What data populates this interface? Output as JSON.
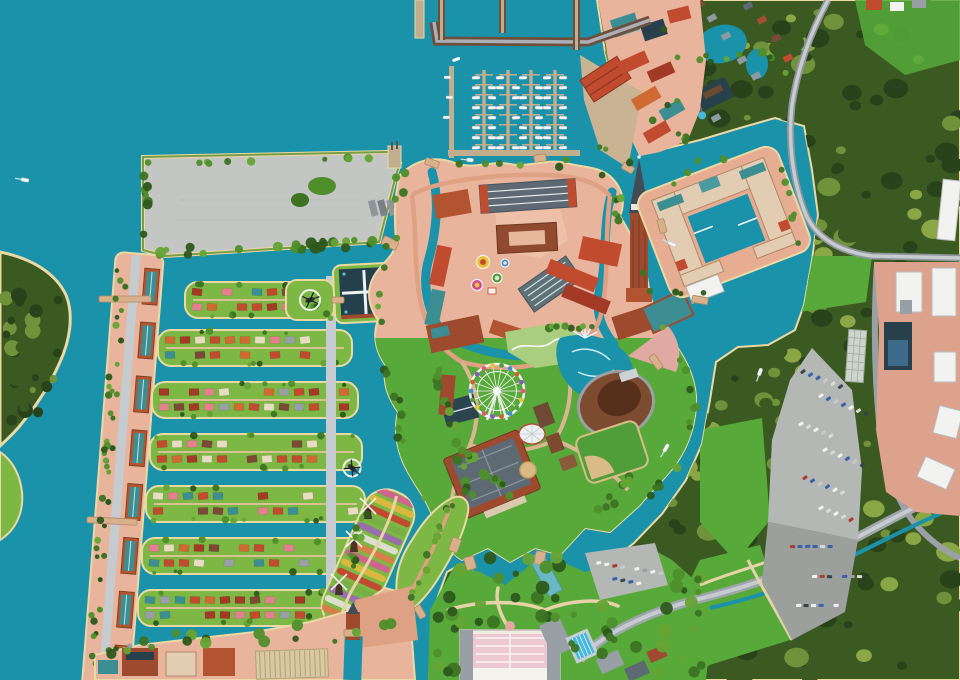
{
  "map": {
    "title": "illustrated-aerial-resort-park-map",
    "description": "Stylized bird's-eye illustrated map of a European canal-town theme resort: marina with boats, fortified central town with cathedral tower, hotel island, amusement gardens with ferris wheel and amphitheater, canal-side residential islands, windmill tulip island, polder field, dense eastern forest with parking and logistics zone.",
    "visible_labels": [],
    "regions": [
      {
        "id": "ocean",
        "label": "Harbor bay water"
      },
      {
        "id": "polder-field",
        "label": "Gray polder event field"
      },
      {
        "id": "marina",
        "label": "Yacht marina"
      },
      {
        "id": "harbor-town",
        "label": "Harbor warehouse town"
      },
      {
        "id": "central-town",
        "label": "Fortified central town"
      },
      {
        "id": "hotel-europe",
        "label": "Canal hotel island"
      },
      {
        "id": "amusement-zone",
        "label": "Amusement gardens"
      },
      {
        "id": "residential-district",
        "label": "Canal residential islands"
      },
      {
        "id": "seaside-boulevard",
        "label": "Seaside condominium boulevard"
      },
      {
        "id": "windmill-island",
        "label": "Windmill tulip island"
      },
      {
        "id": "flower-road-island",
        "label": "Flower road island"
      },
      {
        "id": "south-gardens",
        "label": "South palace gardens"
      },
      {
        "id": "entrance-district",
        "label": "Entrance village"
      },
      {
        "id": "forest-east",
        "label": "Eastern forest"
      },
      {
        "id": "cottage-resort",
        "label": "Forest cottage resort"
      },
      {
        "id": "industrial-zone",
        "label": "Logistics / industrial zone"
      },
      {
        "id": "parking-lot",
        "label": "Main parking lot"
      },
      {
        "id": "left-headland",
        "label": "Wooded headland"
      }
    ],
    "landmarks": [
      "dom-tower",
      "grand-hotel-block",
      "plaza",
      "arcade-hall",
      "ferris-wheel",
      "amphitheater",
      "fountain-lake",
      "dome-tent",
      "museum-palace",
      "sports-field",
      "white-palace-garden",
      "helipads",
      "lock-dam",
      "breakwater"
    ],
    "palette": {
      "water": "#1a92aa",
      "sand": "#ead9a5",
      "forest": "#3a5a22",
      "forest_dark": "#28431a",
      "forest_light": "#6f923a",
      "forest_pale": "#8aa746",
      "lawn": "#57aa3a",
      "lawn_light": "#a9cf7e",
      "island_grass": "#7db844",
      "ground": "#e9b49c",
      "path": "#dfa183",
      "cream": "#e6d3a8",
      "road": "#9fa6ac",
      "road_light": "#c6cbd0",
      "pier": "#c2ad8e",
      "breakwater": "#6e4f3c",
      "brick": "#9e4a2f",
      "brick_light": "#b2542f",
      "roof_red": "#c14b2e",
      "roof_darkred": "#a33a26",
      "roof_teal": "#3d8e92",
      "roof_slate": "#5d6a73",
      "roof_gray": "#98a0a6",
      "roof_navy": "#27404c",
      "roof_orange": "#cf6a33",
      "cream_bldg": "#e3cdb2",
      "white": "#f2f3f1",
      "field": "#c3c6c2",
      "parking": "#b3b8b4",
      "parking_dark": "#9ba09c",
      "pool": "#49b8dd",
      "stadium": "#7c4b30",
      "stadium_dark": "#56301b",
      "seats": "#e0a9a2",
      "dirt": "#d9bc85",
      "salmon_ind": "#dca28c"
    },
    "marina": {
      "dock_x": [
        484,
        508,
        531,
        555
      ],
      "dock_top": 70,
      "dock_bottom": 150,
      "finger_count": 8,
      "boat_len": 8,
      "boat_w": 3,
      "boat_color": "#f4f5f4"
    },
    "residential": {
      "row_height": 36,
      "rows": [
        {
          "x0": 185,
          "x1": 348,
          "y": 282
        },
        {
          "x0": 158,
          "x1": 352,
          "y": 330
        },
        {
          "x0": 152,
          "x1": 358,
          "y": 382
        },
        {
          "x0": 150,
          "x1": 362,
          "y": 434
        },
        {
          "x0": 146,
          "x1": 365,
          "y": 486
        },
        {
          "x0": 142,
          "x1": 368,
          "y": 538
        },
        {
          "x0": 138,
          "x1": 372,
          "y": 590
        }
      ],
      "roof_colors": [
        "#c14b2e",
        "#a33a26",
        "#e2808e",
        "#98a0a6",
        "#3d8e92",
        "#cf6a33",
        "#e8dcc2",
        "#c14b2e",
        "#7b4a36"
      ]
    },
    "ferris_wheel": {
      "cx": 497,
      "cy": 391,
      "r": 27,
      "gondolas": 18,
      "gondola_colors": [
        "#e05a78",
        "#e8c23a",
        "#4f9e3a",
        "#3f8fd2",
        "#d2622f",
        "#8a5ab8"
      ]
    },
    "tulip_colors": [
      "#d85c92",
      "#e0b93e",
      "#c8412e",
      "#76ad47",
      "#9a68b4",
      "#e4e2da",
      "#e07a4a"
    ],
    "car_colors": [
      "#f0f1f1",
      "#f0f1f1",
      "#d7d9da",
      "#9aa0a4",
      "#39434c",
      "#b03a30",
      "#3a62a8",
      "#c8cacb"
    ],
    "tree_colors": [
      "#2d581c",
      "#3c7423",
      "#4f8f2b",
      "#66a436"
    ],
    "counts": {
      "windmills": 3,
      "helicopters": 2,
      "residential_rows": 7,
      "marina_docks": 4,
      "condo_blocks": 8,
      "parking_car_rows": 9
    }
  }
}
